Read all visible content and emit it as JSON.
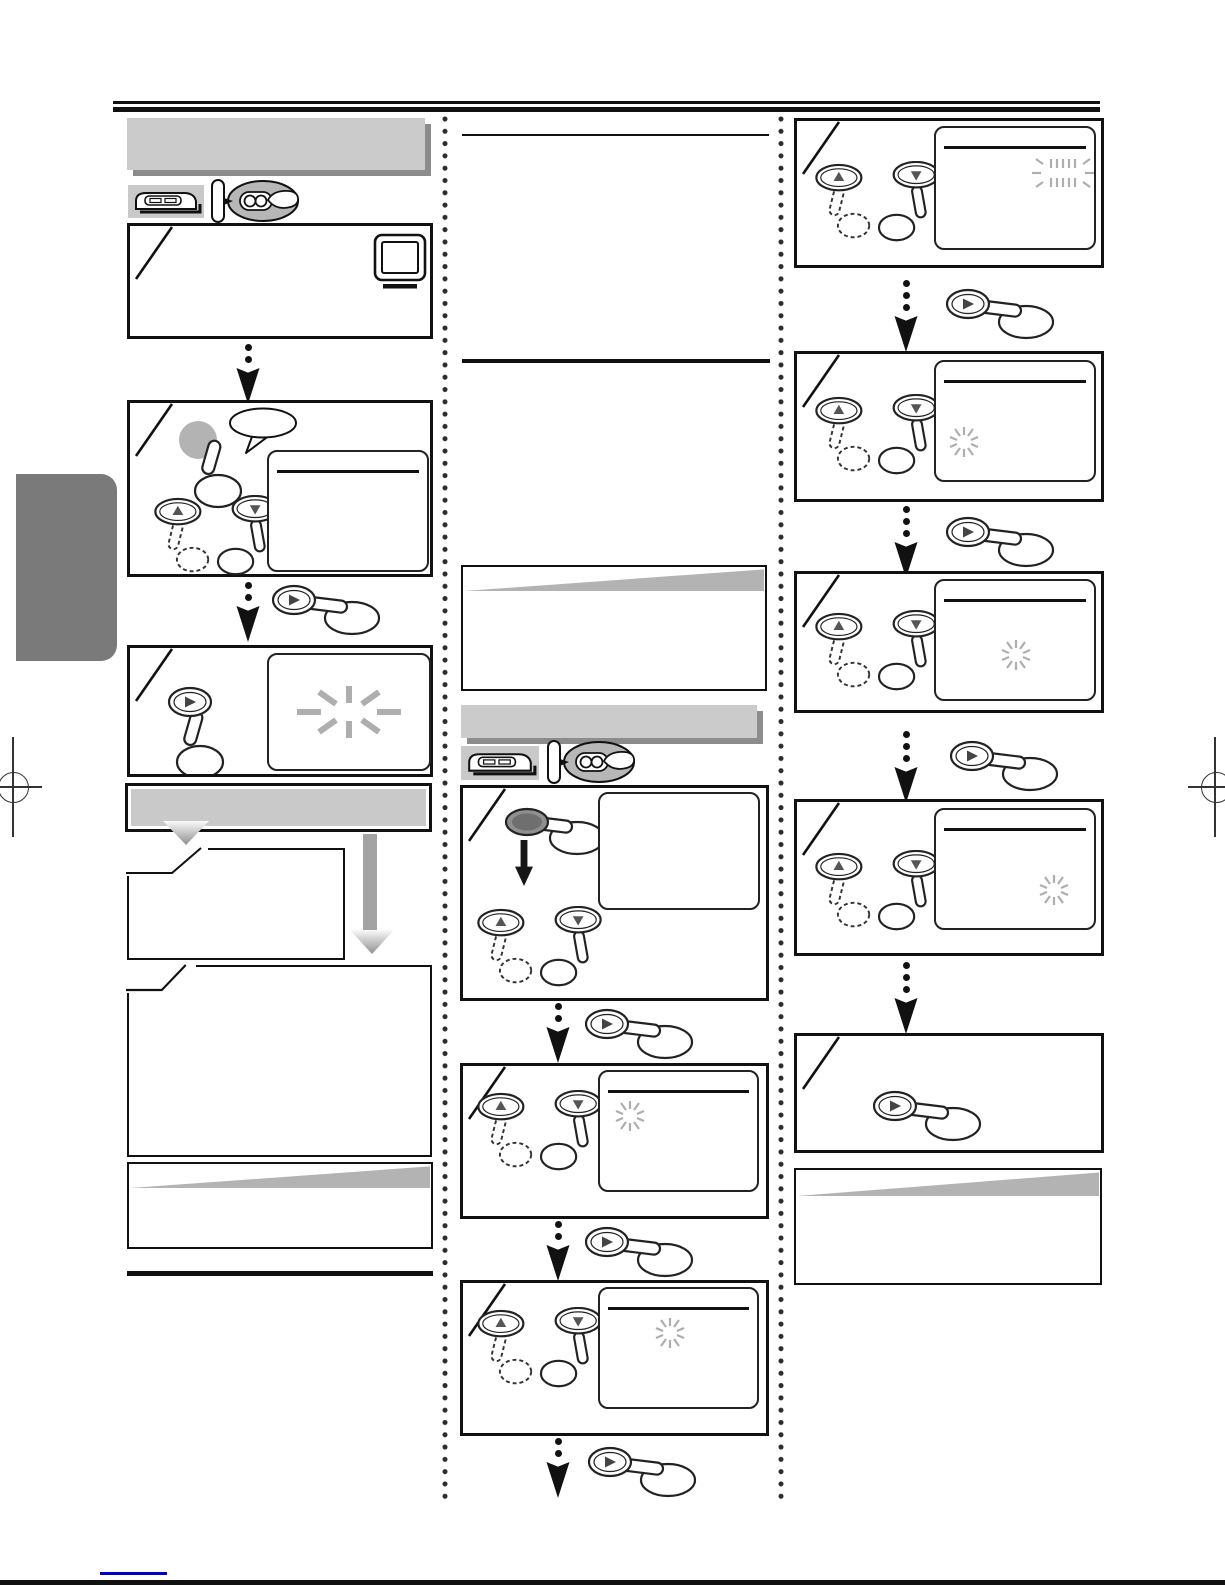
{
  "document": {
    "kind": "scanned-instruction-manual-page",
    "note": "all printed text failed to rasterize in this scan; only rules, boxes and illustrations are visible"
  },
  "colors": {
    "ink": "#111111",
    "banner_gray": "#cbcbcb",
    "banner_shadow": "#8c8c8c",
    "wedge_gray": "#b3b3b3",
    "flash_gray": "#aeaeae",
    "button_gray": "#b3b3b3",
    "dark_button_gray": "#8f8f8f",
    "triangle_dark": "#555555",
    "tab_gray": "#7a7a7a",
    "arrow_gray": "#a3a3a3",
    "footer_blue": "#0000cc"
  },
  "left_column": {
    "title_banner": "blank-gray-title-banner",
    "device_icons": [
      "vcr-icon",
      "remote-hand-icon"
    ],
    "steps": [
      {
        "n": 1,
        "content": [
          "tv-icon"
        ]
      },
      {
        "n": 2,
        "content": [
          "gray-circle-button-press",
          "speech-bubble",
          "up-down-buttons",
          "screen-with-title-line"
        ]
      },
      {
        "n": 3,
        "content": [
          "play-button-press",
          "screen-with-large-flash-burst"
        ]
      }
    ],
    "framed_divider_banner": "blank-framed-gray-banner",
    "branch_boxes": [
      "chamfered-case-box-small",
      "chamfered-case-box-large"
    ],
    "note_box": "blank-note-box-with-gray-wedge",
    "section_end_rule": true
  },
  "middle_column": {
    "heading_underlines": 2,
    "note_box": "blank-note-box-with-gray-wedge",
    "section_banner": "blank-gray-section-banner",
    "device_icons": [
      "vcr-icon",
      "remote-hand-icon"
    ],
    "steps": [
      {
        "n": 1,
        "content": [
          "dark-oval-button-press",
          "black-down-arrow",
          "up-down-buttons",
          "empty-screen"
        ]
      },
      {
        "n": 2,
        "content": [
          "up-down-buttons",
          "screen-with-title-line",
          "flash-burst-left"
        ]
      },
      {
        "n": 3,
        "content": [
          "up-down-buttons",
          "screen-with-title-line",
          "flash-burst-center"
        ]
      }
    ],
    "arrows_with_play_hand": 3
  },
  "right_column": {
    "steps": [
      {
        "n": 1,
        "content": [
          "up-down-buttons",
          "screen-with-title-line",
          "flashing-segment-display-top-right"
        ]
      },
      {
        "n": 2,
        "content": [
          "up-down-buttons",
          "screen-with-title-line",
          "flash-burst-left"
        ]
      },
      {
        "n": 3,
        "content": [
          "up-down-buttons",
          "screen-with-title-line",
          "flash-burst-center"
        ]
      },
      {
        "n": 4,
        "content": [
          "up-down-buttons",
          "screen-with-title-line",
          "flash-burst-bottom-right"
        ]
      },
      {
        "n": 5,
        "content": [
          "play-button-hand"
        ]
      }
    ],
    "note_box": "blank-note-box-with-gray-wedge"
  },
  "page_furniture": {
    "top_rule": "double-black-rule",
    "bottom_rule": "black-rule",
    "footer_underline_color": "#0000cc",
    "registration_marks": 2,
    "chapter_tab": "gray-side-tab"
  }
}
